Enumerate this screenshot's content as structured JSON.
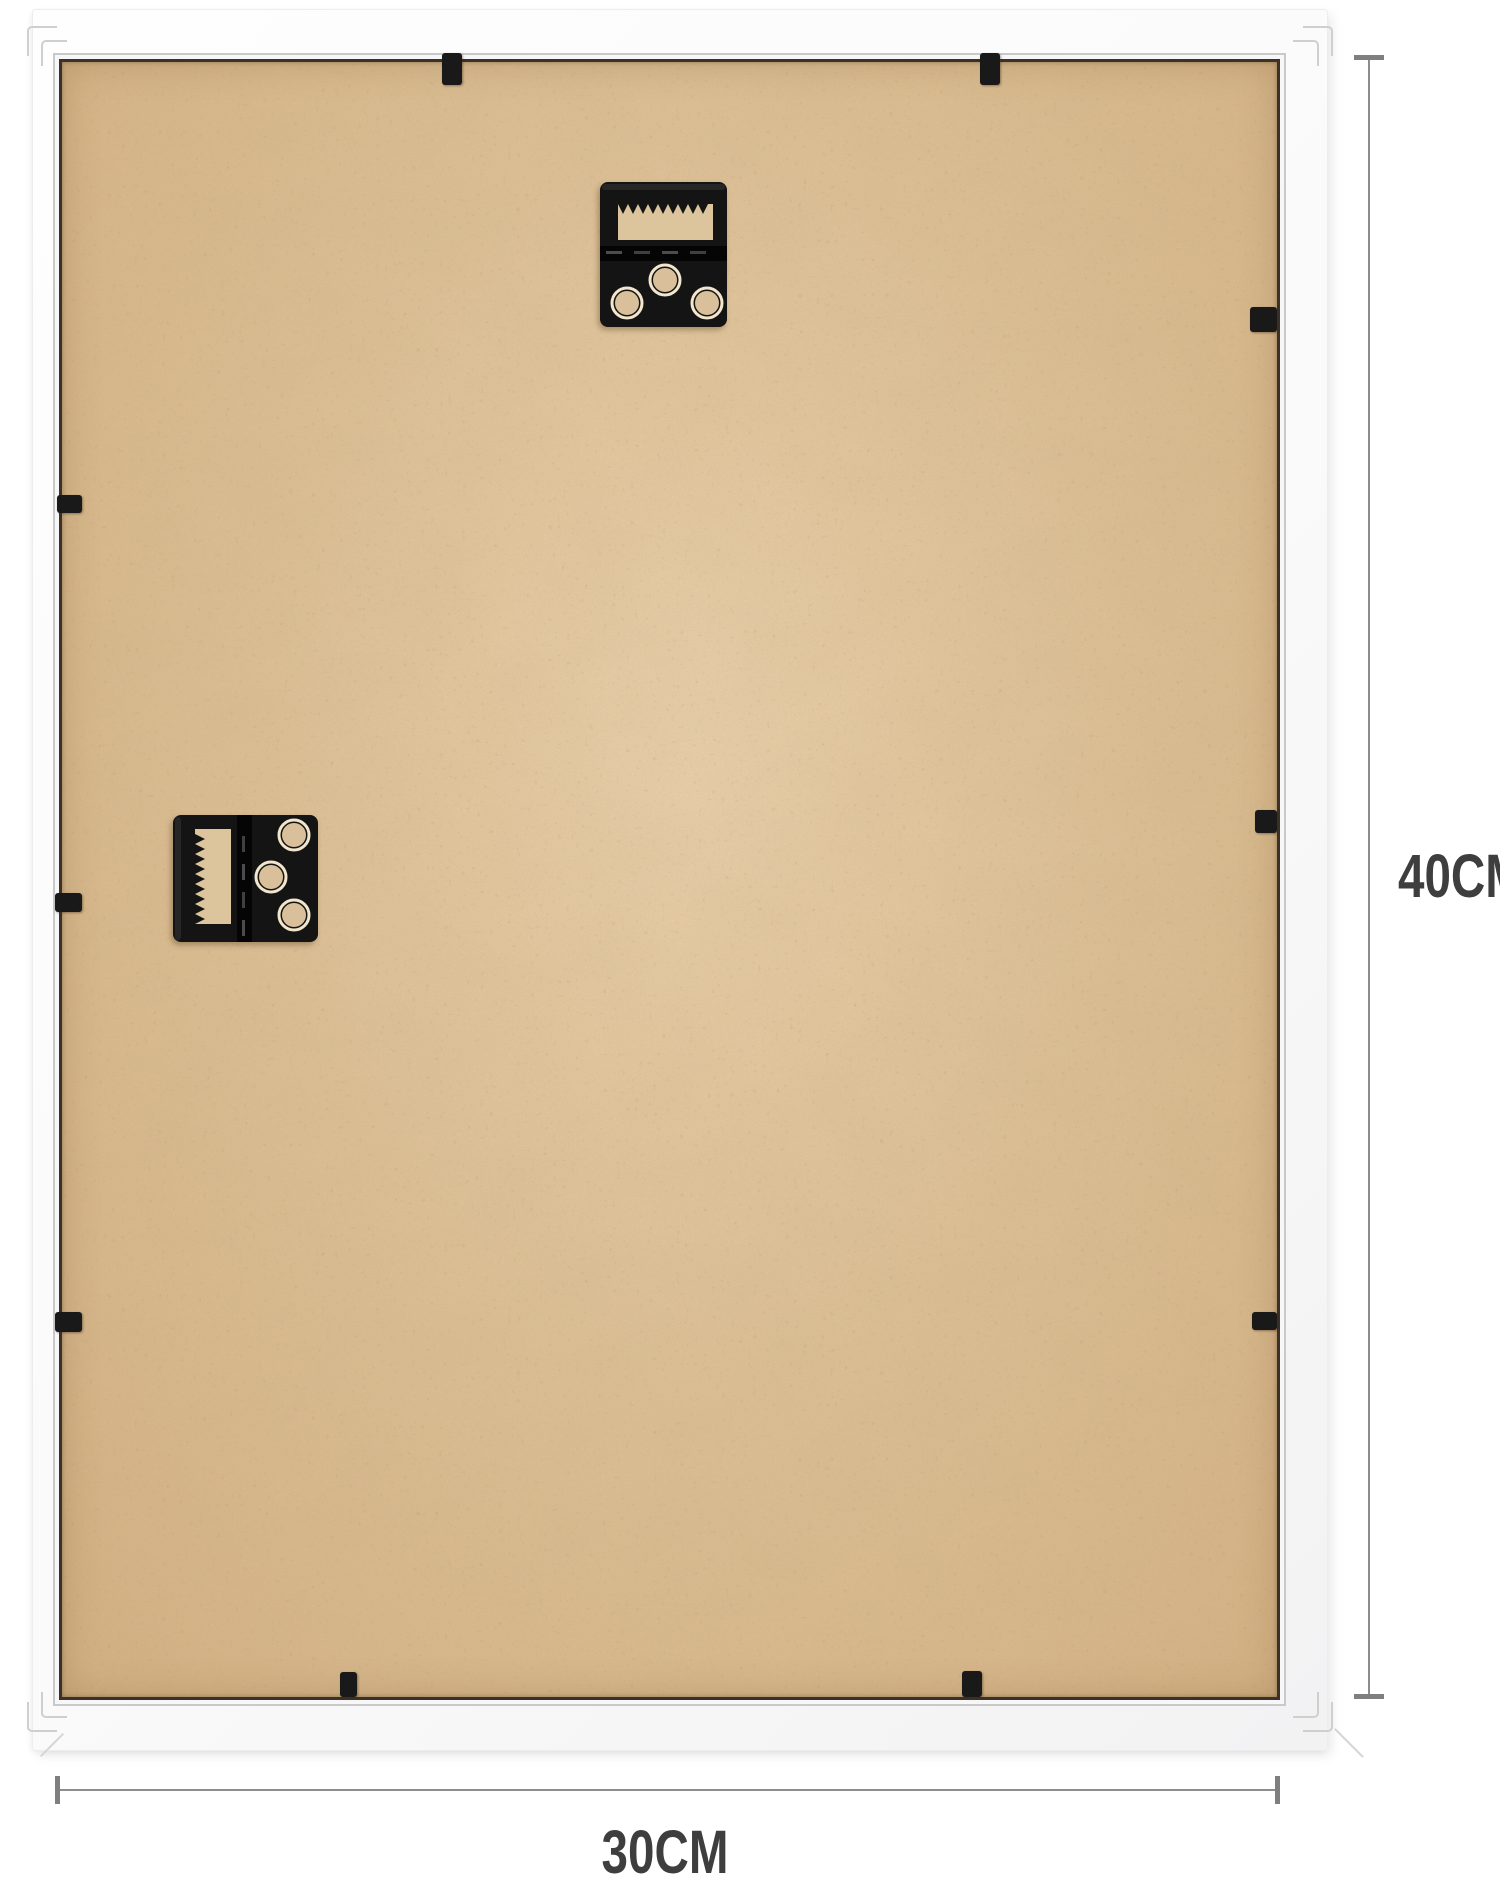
{
  "annotations": {
    "height_label": "40CM",
    "width_label": "30CM"
  },
  "colors": {
    "board_tan": "#ddc096",
    "hardware_black": "#191919",
    "gap_dark": "#3a3128",
    "dimension_gray": "#8d8d8d",
    "dimension_text": "#3e3e3e",
    "frame_white": "#fbfbfb"
  },
  "hardware": {
    "hangers": [
      {
        "name": "sawtooth-hanger-top",
        "orientation": "portrait",
        "x": 538,
        "y": 120,
        "w": 127,
        "h": 145
      },
      {
        "name": "sawtooth-hanger-side",
        "orientation": "landscape",
        "x": 111,
        "y": 753,
        "w": 145,
        "h": 127
      }
    ],
    "clips": [
      {
        "edge": "top",
        "x": 380,
        "y": -9,
        "w": 20,
        "h": 32
      },
      {
        "edge": "top",
        "x": 918,
        "y": -9,
        "w": 20,
        "h": 32
      },
      {
        "edge": "left",
        "x": -5,
        "y": 433,
        "w": 25,
        "h": 18
      },
      {
        "edge": "left",
        "x": -7,
        "y": 831,
        "w": 27,
        "h": 19
      },
      {
        "edge": "left",
        "x": -7,
        "y": 1250,
        "w": 27,
        "h": 20
      },
      {
        "edge": "right",
        "x": 1188,
        "y": 245,
        "w": 27,
        "h": 25
      },
      {
        "edge": "right",
        "x": 1193,
        "y": 748,
        "w": 22,
        "h": 23
      },
      {
        "edge": "right",
        "x": 1190,
        "y": 1250,
        "w": 25,
        "h": 18
      },
      {
        "edge": "bottom",
        "x": 278,
        "y": 1610,
        "w": 17,
        "h": 25
      },
      {
        "edge": "bottom",
        "x": 900,
        "y": 1609,
        "w": 20,
        "h": 26
      }
    ]
  }
}
